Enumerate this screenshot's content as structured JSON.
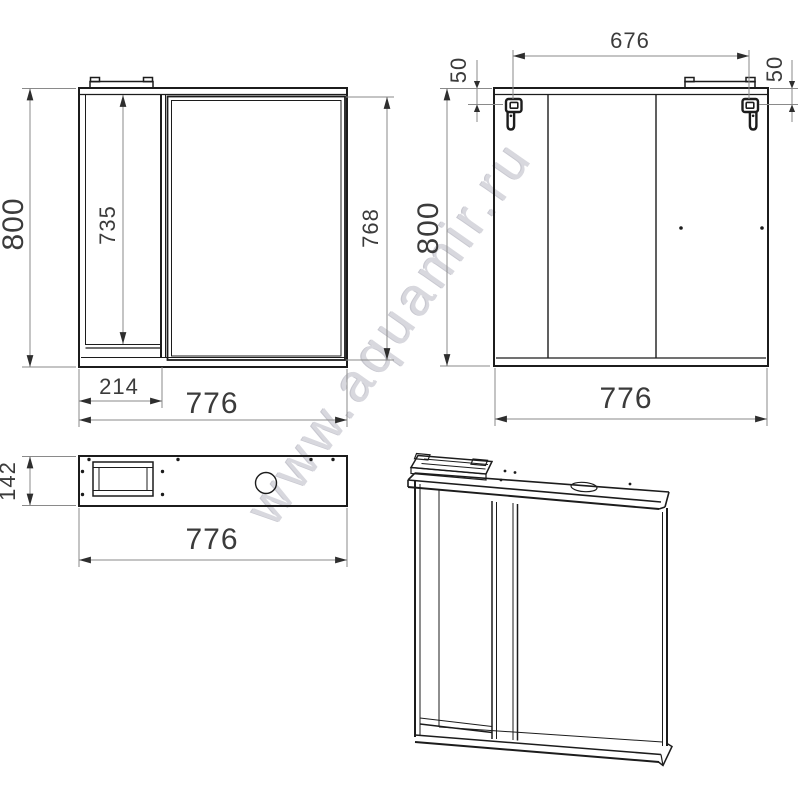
{
  "watermark": {
    "text": "www.aquamir.ru"
  },
  "colors": {
    "outline": "#1c1c1c",
    "dimension_line": "#8a8a8a",
    "arrow": "#2e2e2e",
    "label_text": "#3b3b3b",
    "watermark_text": "#d2d2d9",
    "background": "#ffffff"
  },
  "views": {
    "front": {
      "height": "800",
      "shelf_height": "735",
      "mirror_height": "768",
      "shelf_width": "214",
      "width": "776"
    },
    "back": {
      "hanger_spacing": "676",
      "hanger_offset_left": "50",
      "hanger_offset_right": "50",
      "height": "800",
      "width": "776"
    },
    "top": {
      "depth": "142",
      "width": "776"
    }
  }
}
